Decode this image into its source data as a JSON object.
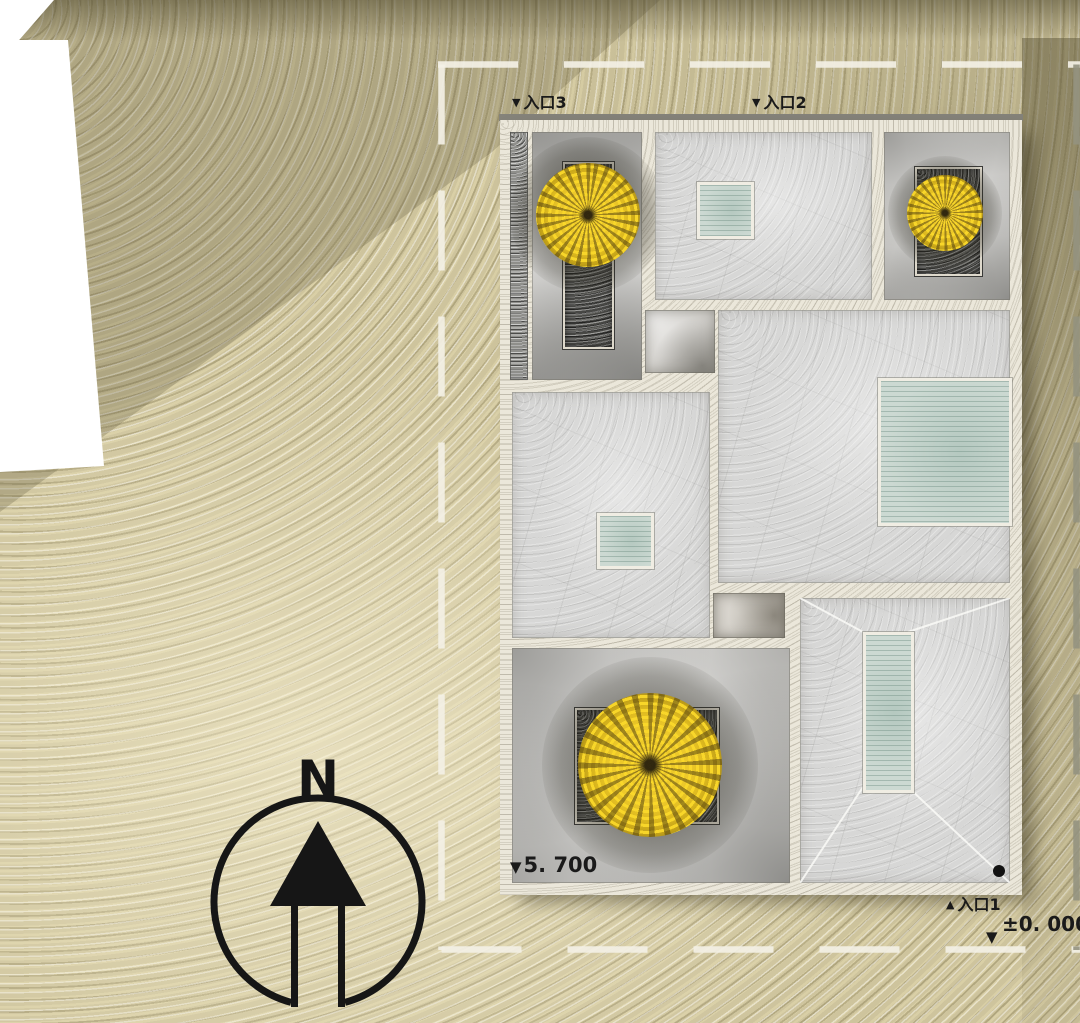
{
  "annotations": {
    "entrance_3": {
      "marker": "▼",
      "label": "入口3"
    },
    "entrance_2": {
      "marker": "▼",
      "label": "入口2"
    },
    "entrance_1": {
      "marker": "▲",
      "label": "入口1"
    },
    "roof_elevation": {
      "marker": "▼",
      "value": "5. 700"
    },
    "ground_elevation": {
      "marker": "▼",
      "value": "±0. 000"
    }
  },
  "north_indicator": {
    "letter": "N"
  },
  "palette": {
    "sand": "#cec49d",
    "sand_shadow": "#5f5939",
    "building_wall": "#ebe7da",
    "roof_concrete": "#d7d7d6",
    "courtyard_floor": "#e6e5e2",
    "skylight_glass": "#ccd9d2",
    "planter_gravel": "#474744",
    "tree_foliage": "#e4c021",
    "boundary_line": "#f3f0e5",
    "neighbor_roof": "#ffffff",
    "text": "#1a1a1a",
    "point_marker": "#121212"
  },
  "icons": {
    "north_arrow": "compass-arrow-up",
    "down_triangle": "▼",
    "up_triangle": "▲",
    "point_marker": "●"
  }
}
